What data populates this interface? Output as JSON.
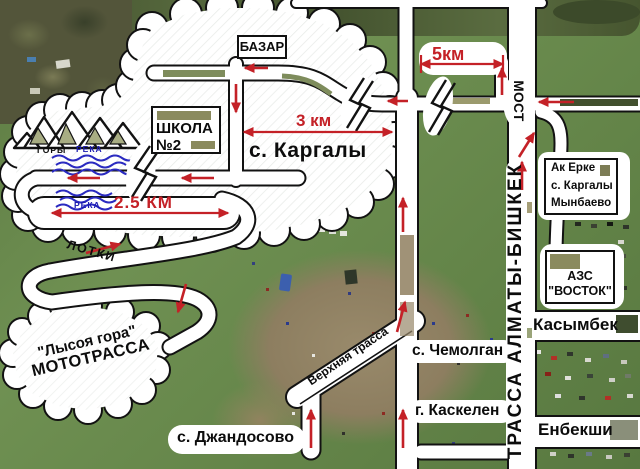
{
  "labels": {
    "bazar": "БАЗАР",
    "school_line1": "ШКОЛА",
    "school_line2": "№2",
    "kargaly": "с. Каргалы",
    "dist_3km": "3 км",
    "dist_5km": "5км",
    "dist_25km": "2.5 КМ",
    "gory": "ГОРЫ",
    "reka_upper": "РЕКА",
    "reka_lower": "РЕКА",
    "lotki": "ЛОТКИ",
    "moto_line1": "\"Лысоя гора\"",
    "moto_line2": "МОТОТРАССА",
    "verkhnyaya": "Верхняя трасса",
    "chemolgan": "с. Чемолган",
    "kaskelen": "г. Каскелен",
    "dzhandosovo": "с. Джандосово",
    "most": "МОСТ",
    "highway": "ТРАССА АЛМАТЫ-БИШКЕК",
    "akerke_line1": "Ак Ерке",
    "akerke_line2": "с. Каргалы",
    "akerke_line3": "Мынбаево",
    "azs_line1": "АЗС",
    "azs_line2": "\"ВОСТОК\"",
    "kasymbek": "Касымбек",
    "enbekshi": "Енбекши"
  },
  "colors": {
    "arrow_red": "#c42127",
    "river_blue": "#2a2ac0",
    "road_fill": "#ffffff",
    "road_edge": "#121212"
  }
}
